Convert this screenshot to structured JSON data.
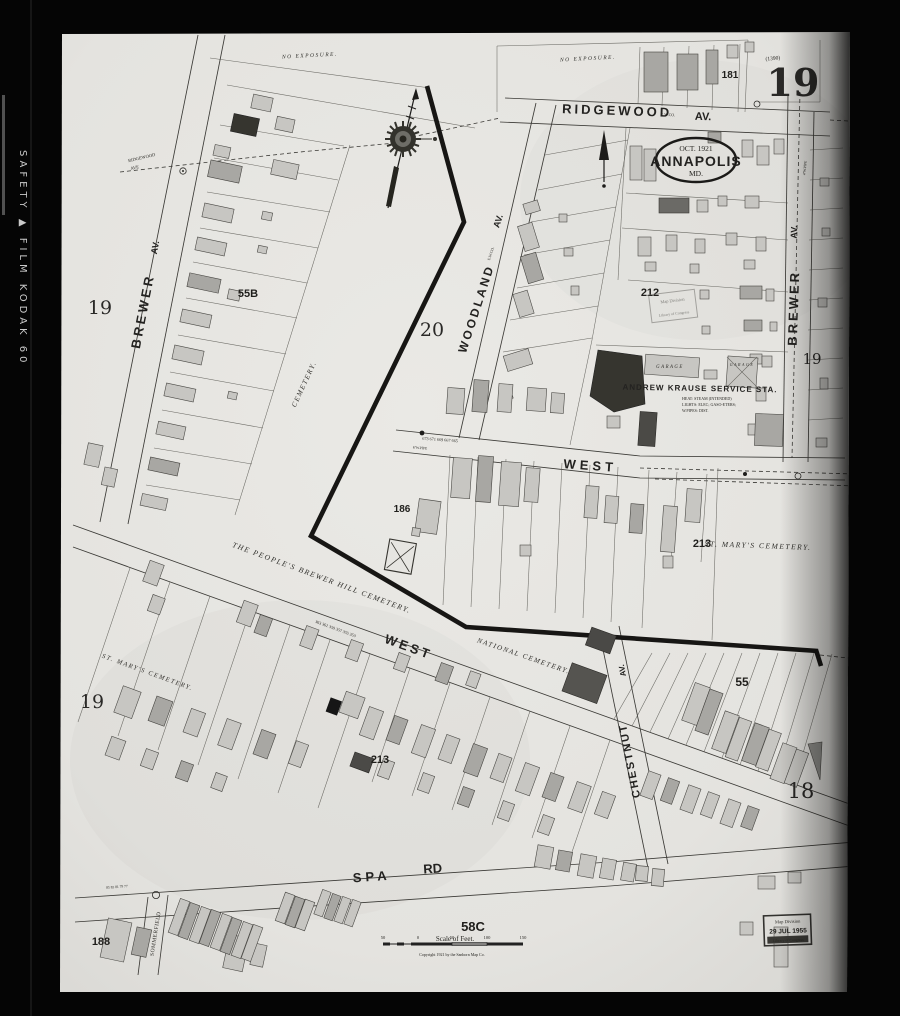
{
  "film": {
    "edge_text": "SAFETY ▲ FILM KODAK 60"
  },
  "sheet": {
    "big_number": "19",
    "plate_note": "(1390)",
    "adjacent_20": "20",
    "adjacent_18": "18",
    "left_19": "19",
    "mid_19": "19",
    "right_19": "19"
  },
  "title": {
    "date": "OCT. 1921",
    "city": "ANNAPOLIS",
    "state": "MD."
  },
  "streets": {
    "ridgewood": "RIDGEWOOD",
    "ridgewood_av": "AV.",
    "ridgewood_small_1": "RIDGEWOOD",
    "ridgewood_small_2": "AVE",
    "brewer_left": "BREWER",
    "brewer_left_av": "AV.",
    "brewer_right": "BREWER",
    "brewer_right_av": "AV.",
    "woodland": "WOODLAND",
    "woodland_av": "AV.",
    "west_upper": "WEST",
    "west_lower": "WEST",
    "chestnut": "CHESTNUT",
    "chestnut_av": "AV.",
    "spa": "SPA",
    "spa_rd": "RD",
    "sommerfield": "SOMMERFIELD"
  },
  "blocks": {
    "b181": "181",
    "b55b": "55B",
    "b212": "212",
    "b186": "186",
    "b213_upper": "213",
    "b213_lower": "213",
    "b55": "55",
    "b58c": "58C",
    "b188": "188"
  },
  "labels": {
    "no_exposure_left": "NO EXPOSURE.",
    "no_exposure_right": "NO EXPOSURE.",
    "cemetery_side": "CEMETERY.",
    "peoples_cemetery": "THE PEOPLE'S BREWER HILL CEMETERY.",
    "national_cemetery": "NATIONAL CEMETERY.",
    "st_marys_cemetery_right": "ST. MARY'S CEMETERY.",
    "st_marys_cemetery_left": "ST. MARY'S CEMETERY.",
    "krause_title": "ANDREW KRAUSE SERVICE STA.",
    "krause_note_1": "HEAT: STEAM (INTENDED)",
    "krause_note_2": "LIGHTS: ELEC; GASO-ETERS;",
    "krause_note_3": "W.PIPES: DIST.",
    "garage_1": "GARAGE",
    "garage_2": "GARAGE",
    "pipe_note_ridgewood": "E.W.CO.",
    "pipe_note_woodland": "E.W.CO.",
    "pipe_note_west": "6''W.PIPE",
    "pipe_note_brewer": "4''W.PIPE"
  },
  "house_numbers": {
    "west_upper": "673  671  669  667  665",
    "west_lower": "363  361  359  357  355  353",
    "spa": "85  83  81  79  77"
  },
  "scale_bar": {
    "label": "Scale of Feet.",
    "ticks": [
      "50",
      "0",
      "50",
      "100",
      "150"
    ],
    "copyright": "Copyright 1921 by the Sanborn Map Co."
  },
  "stamps": {
    "faint": {
      "line1": "Map Division",
      "line2": "Library of Congress"
    },
    "dated": {
      "line1": "Map Division",
      "line2": "29 JUL 1955",
      "line3": "Library of Congress"
    }
  },
  "colors": {
    "paper": "#e6e5e1",
    "ink": "#1f1e1c",
    "film": "#060606"
  }
}
